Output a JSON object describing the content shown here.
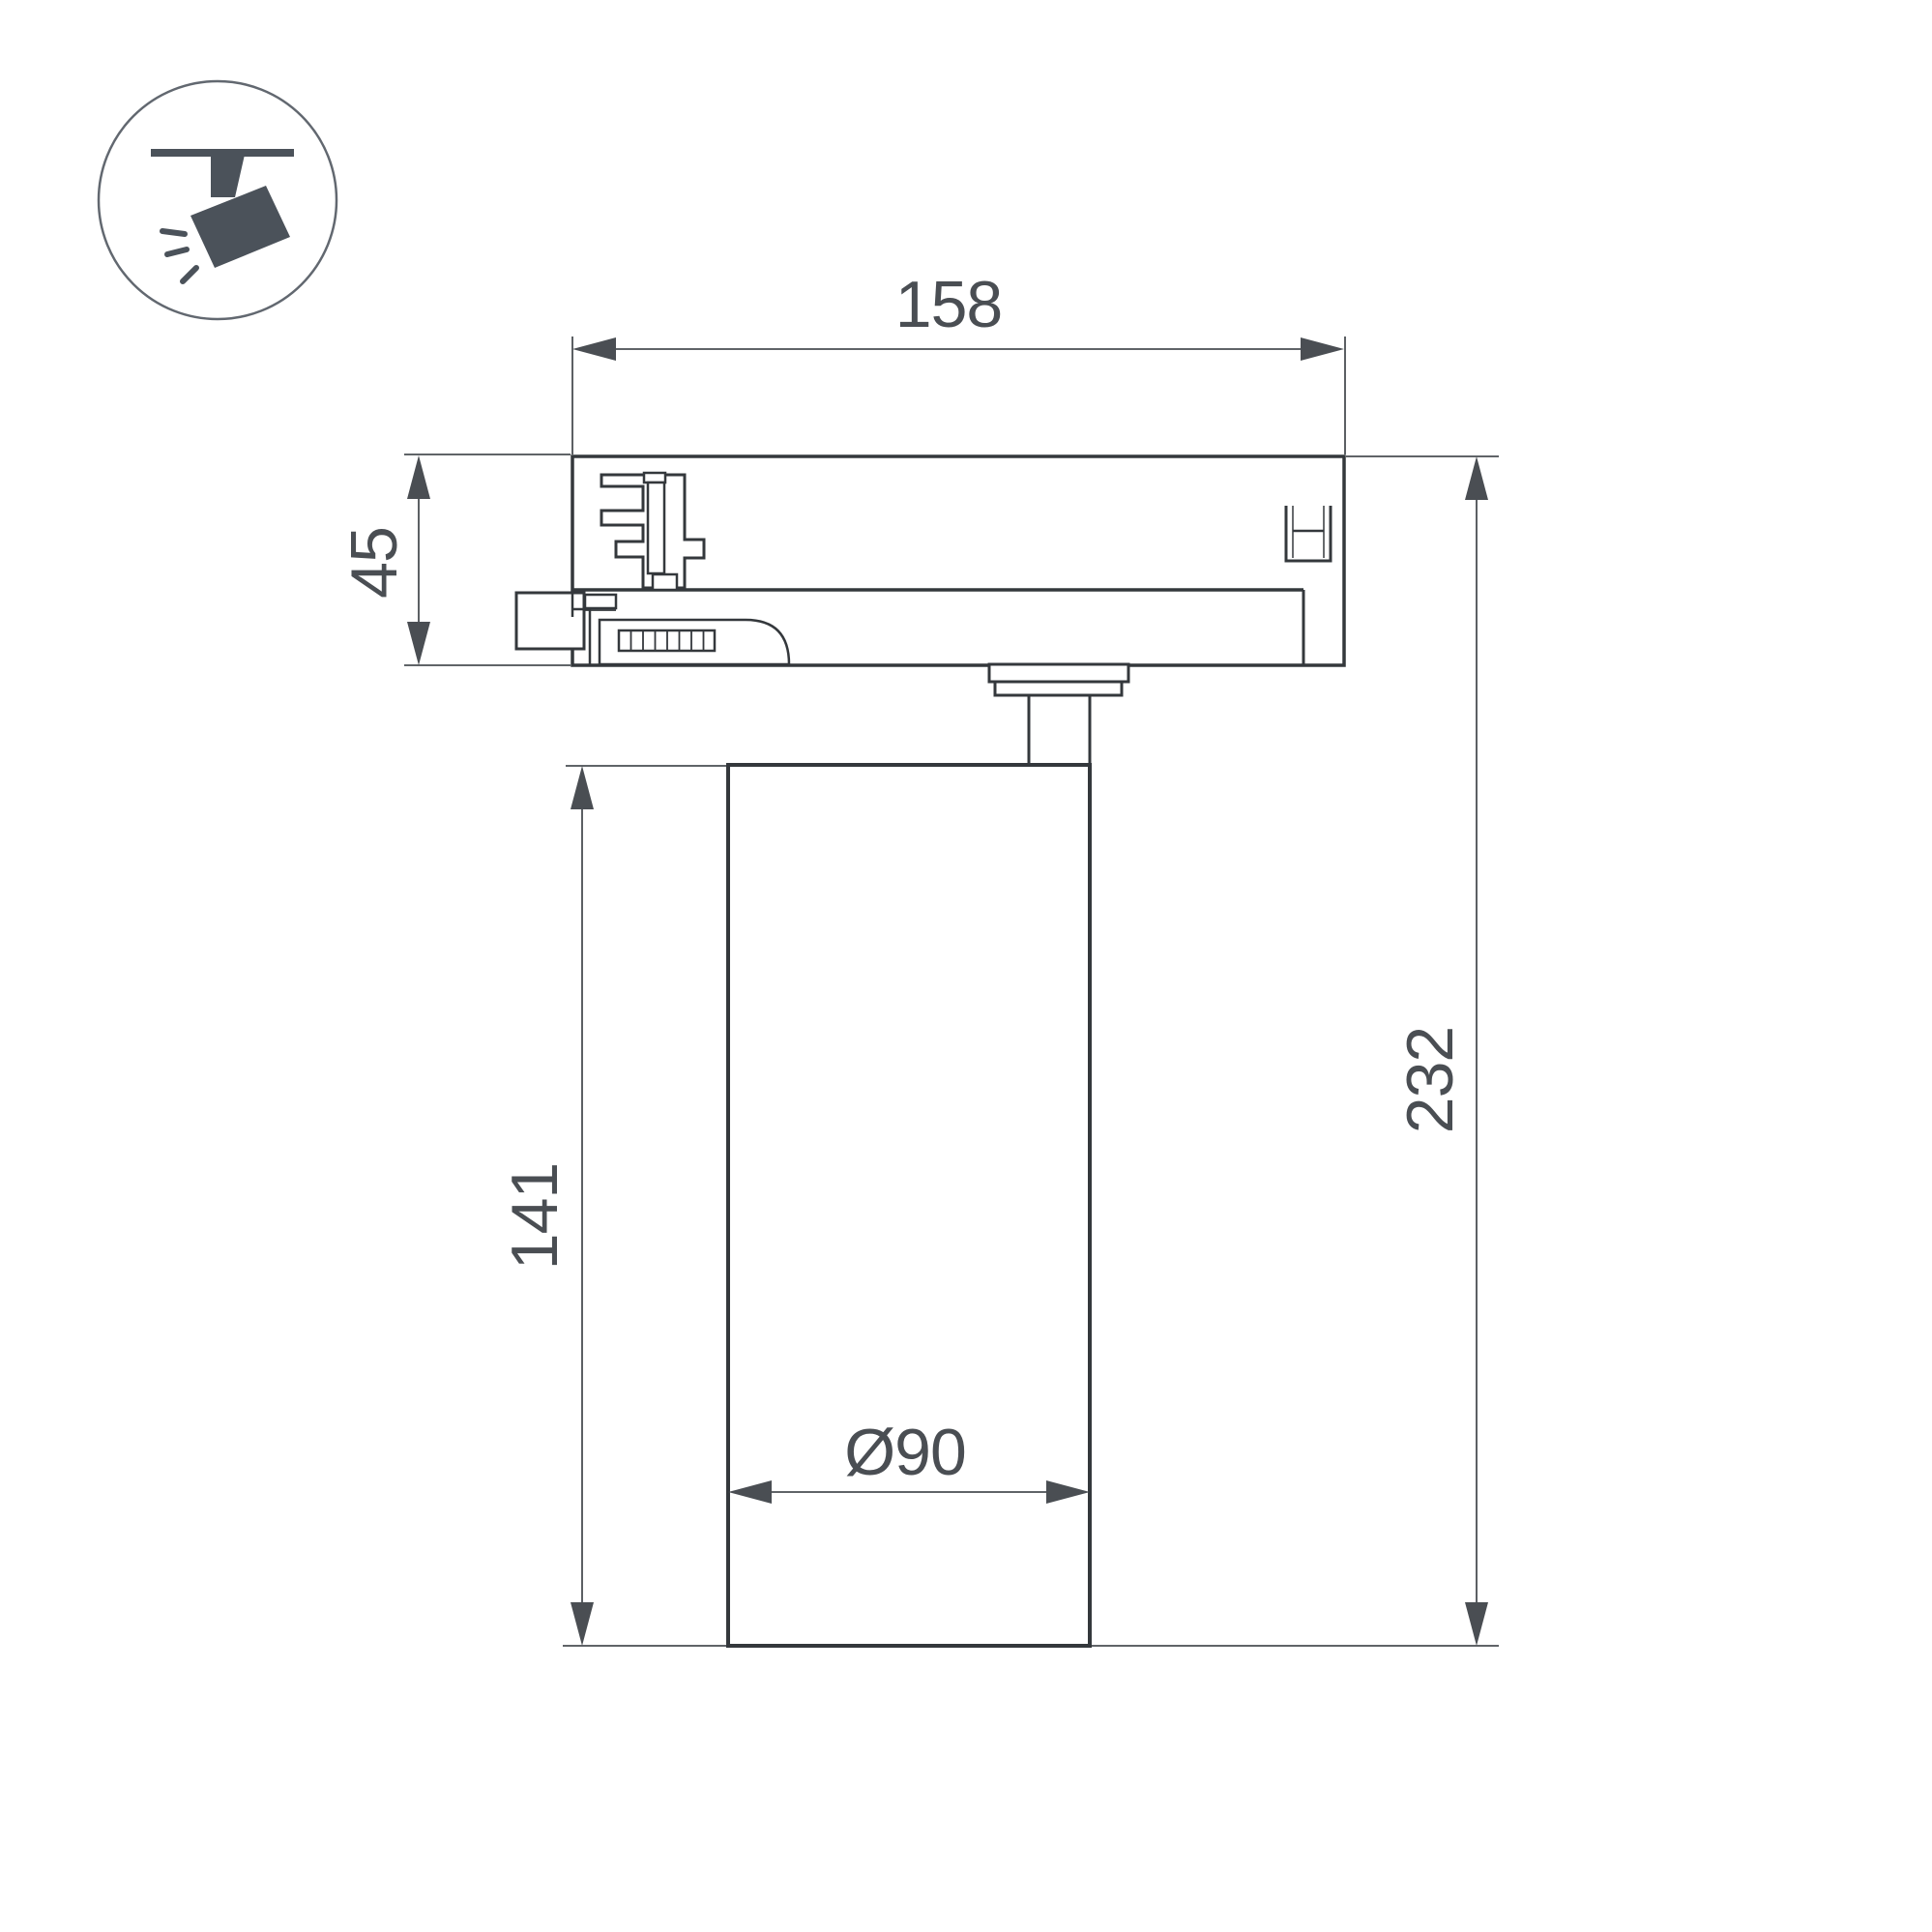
{
  "page": {
    "background": "#ffffff"
  },
  "icon": {
    "semantic": "track-spotlight-icon",
    "glyph_color": "#4b525a",
    "circle_color": "#626870"
  },
  "drawing": {
    "type": "technical-dimension-drawing",
    "subject": "track-mounted cylindrical spotlight, side view",
    "line_color": "#34383c",
    "dim_color": "#4a4e53",
    "dimensions": {
      "adapter_width": {
        "label": "158"
      },
      "adapter_height": {
        "label": "45"
      },
      "body_height": {
        "label": "141"
      },
      "total_height": {
        "label": "232"
      },
      "body_diameter": {
        "label": "Ø90"
      }
    }
  }
}
